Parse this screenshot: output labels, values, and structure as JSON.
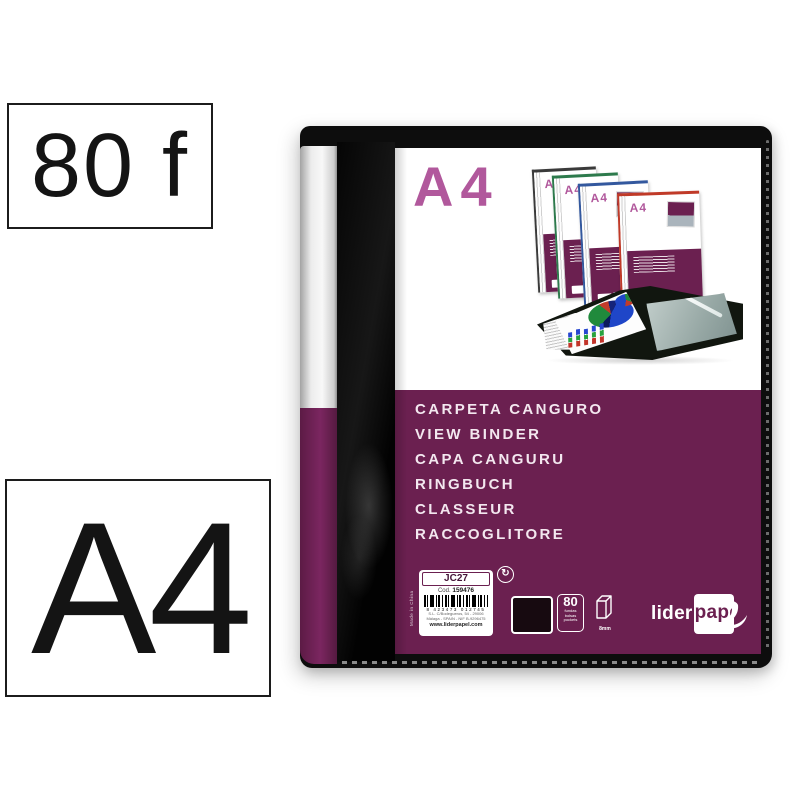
{
  "badges": {
    "sheets": "80 f",
    "format": "A4"
  },
  "binder": {
    "cover_format": "A4",
    "product_names": [
      "CARPETA CANGURO",
      "VIEW BINDER",
      "CAPA CANGURU",
      "RINGBUCH",
      "CLASSEUR",
      "RACCOGLITORE"
    ],
    "label": {
      "model": "JC27",
      "code_label": "Cod.",
      "code_value": "159476",
      "barcode_text": "8 423473 012745",
      "address_line1": "S.L. C/Bodegueros, 54 - 29006",
      "address_line2": "Málaga - SPAIN - NIF B-9296475",
      "website": "www.liderpapel.com",
      "origin": "Made in China"
    },
    "specs": {
      "pocket_count": "80",
      "pocket_words": [
        "fundas",
        "bolsas",
        "pockets"
      ],
      "spine_size": "8mm"
    },
    "brand": {
      "name": "liderpapel",
      "part1": "lider",
      "part2": "pape",
      "part3": "l"
    },
    "montage": {
      "mini_format": "A4"
    }
  },
  "colors": {
    "cover_purple": "#6b2050",
    "accent_magenta": "#b1589c",
    "mini_spines": [
      "#3a3a3a",
      "#2d7a4c",
      "#33589e",
      "#c03a28"
    ]
  }
}
